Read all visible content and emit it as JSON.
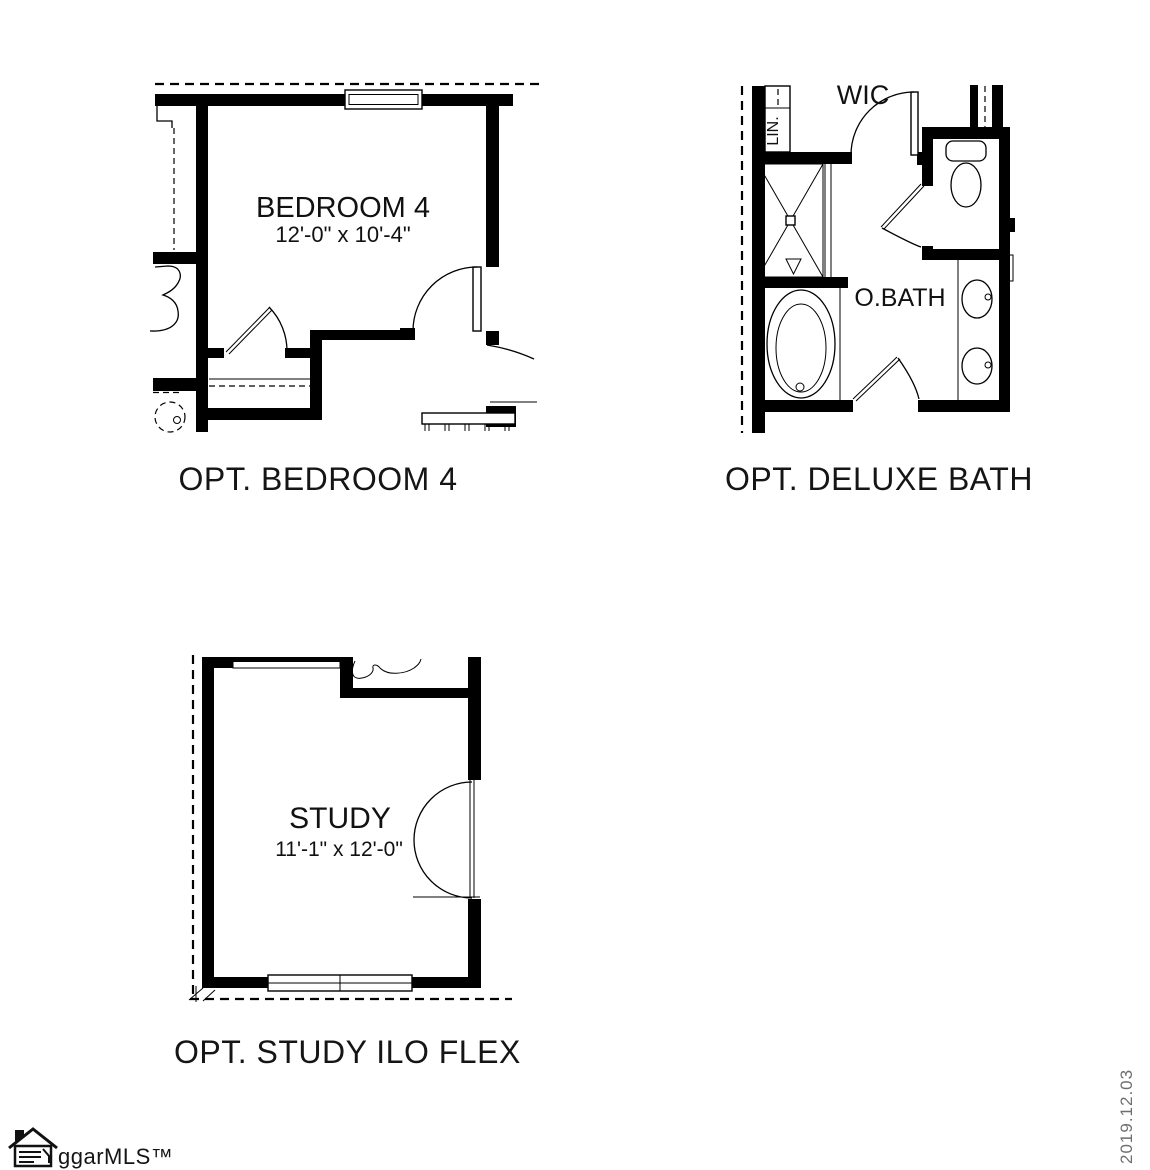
{
  "plans": {
    "bedroom": {
      "caption": "OPT. BEDROOM 4",
      "room_label": "BEDROOM 4",
      "room_dimensions": "12'-0\" x 10'-4\""
    },
    "bath": {
      "caption": "OPT. DELUXE BATH",
      "room_label": "O.BATH",
      "wic_label": "WIC",
      "linen_label": "LIN."
    },
    "study": {
      "caption": "OPT. STUDY ILO FLEX",
      "room_label": "STUDY",
      "room_dimensions": "11'-1\" x 12'-0\""
    }
  },
  "footer": {
    "logo_text": "ggarMLS™",
    "date_stamp": "2019.12.03"
  },
  "icons": {
    "logo_house_icon": "house-with-document-lines",
    "bath_fixtures": [
      "shower",
      "tub",
      "toilet",
      "double-vanity-sinks"
    ],
    "bedroom_fixtures": [
      "swing-doors",
      "stair-railing"
    ],
    "study_fixtures": [
      "double-swing-door",
      "window"
    ]
  },
  "colors": {
    "line": "#000000",
    "date_gray": "#6e6e6e",
    "background": "#ffffff"
  }
}
